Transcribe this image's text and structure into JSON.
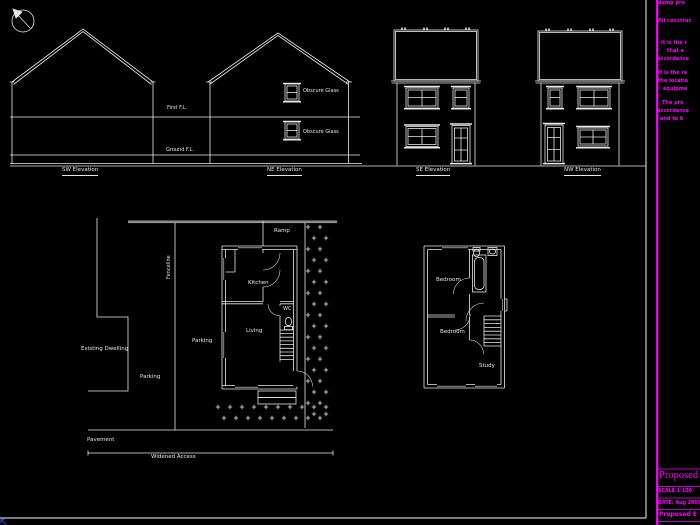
{
  "canvas": {
    "background": "#000000",
    "line_color": "#e8e8e8",
    "accent_magenta": "#ff00ff"
  },
  "elevations": {
    "sw_label": "SW Elevation",
    "ne_label": "NE Elevation",
    "se_label": "SE Elevation",
    "nw_label": "NW Elevation",
    "first_floor_level": "First F.L.",
    "ground_floor_level": "Ground F.L.",
    "obscure_glass_upper": "Obscure Glass",
    "obscure_glass_lower": "Obscure Glass"
  },
  "site_plan": {
    "fenceline": "Fenceline",
    "existing_dwelling": "Existing Dwelling",
    "parking_upper": "Parking",
    "parking_lower": "Parking",
    "pavement": "Pavement",
    "widened_access": "Widened Access"
  },
  "ground_floor_plan": {
    "ramp": "Ramp",
    "kitchen": "Kitchen",
    "wc": "WC",
    "living": "Living"
  },
  "first_floor_plan": {
    "bedroom_front": "Bedroom",
    "bedroom_back": "Bedroom",
    "study": "Study"
  },
  "notes": {
    "line_1": "damp pro",
    "line_2": "All construc",
    "line_3": "It is the r",
    "line_4": "that a",
    "line_5": "accordance",
    "line_6": "It is the re",
    "line_7": "the locatio",
    "line_8": "equipme",
    "line_9": "The pro",
    "line_10": "accordance",
    "line_11": "and to b"
  },
  "title_block": {
    "project_title": "Proposed",
    "scale": "SCALE 1:100",
    "date": "DATE: Aug 2009",
    "drawing_title": "Proposed E"
  }
}
